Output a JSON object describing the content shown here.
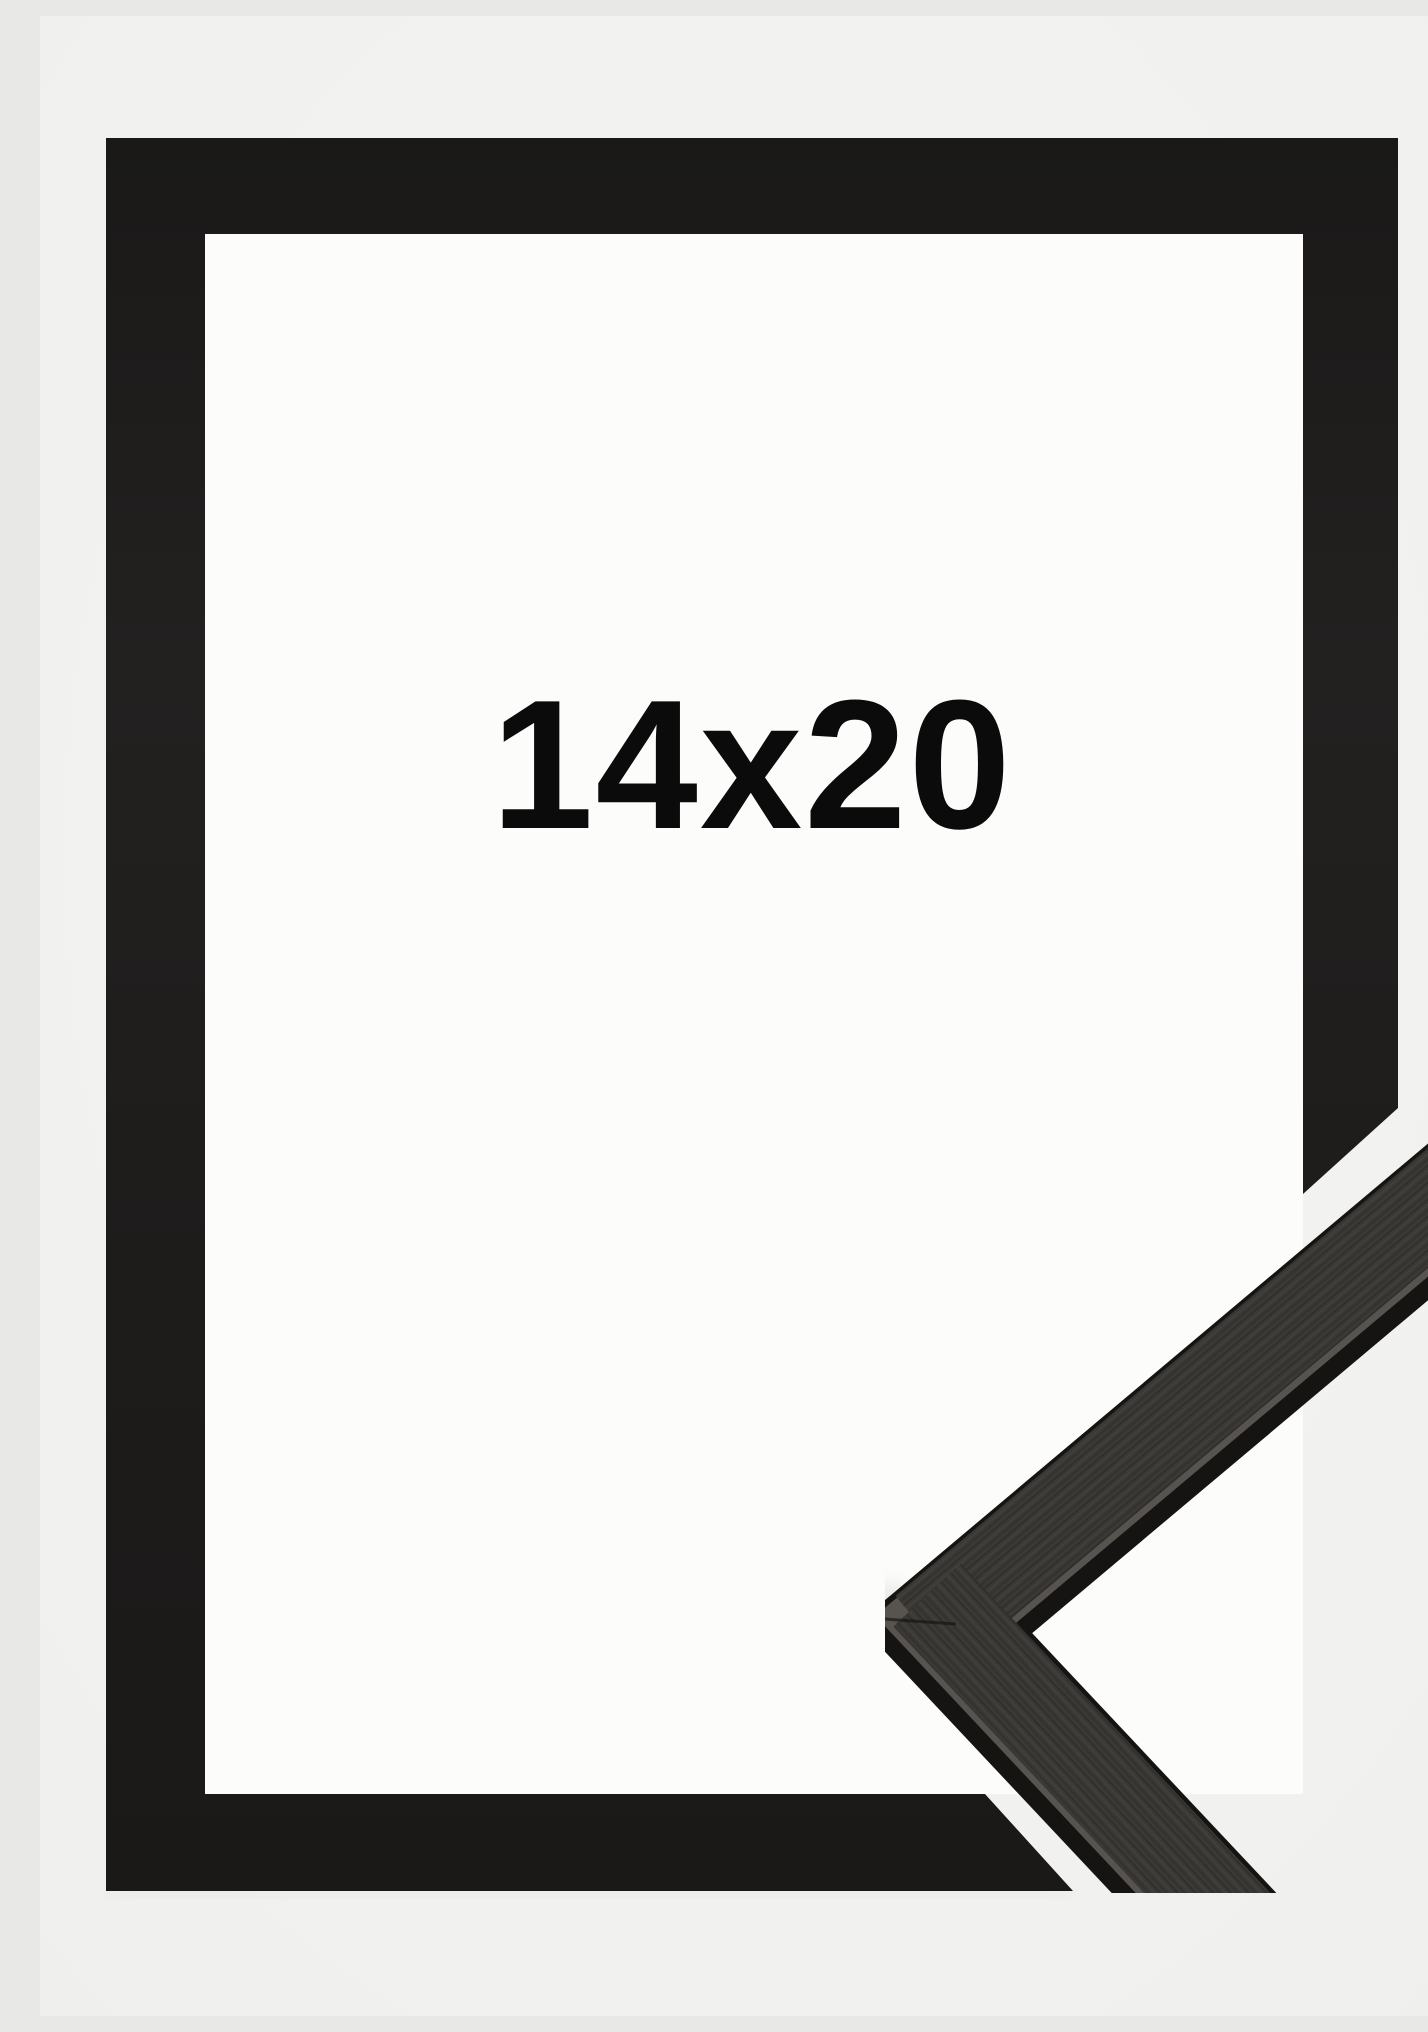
{
  "image": {
    "description": "Product photo of a black wooden picture frame shown with a mitred corner profile sample overlapping the bottom-right corner",
    "size_label": "14x20"
  },
  "colors": {
    "background": "#f1f1ef",
    "mat_white": "#fcfcfb",
    "frame_black": "#1d1b1a",
    "molding_face": "#3b3936",
    "molding_edge": "#151413",
    "edge_highlight": "#57534e",
    "label_text": "#0b0b0b"
  }
}
